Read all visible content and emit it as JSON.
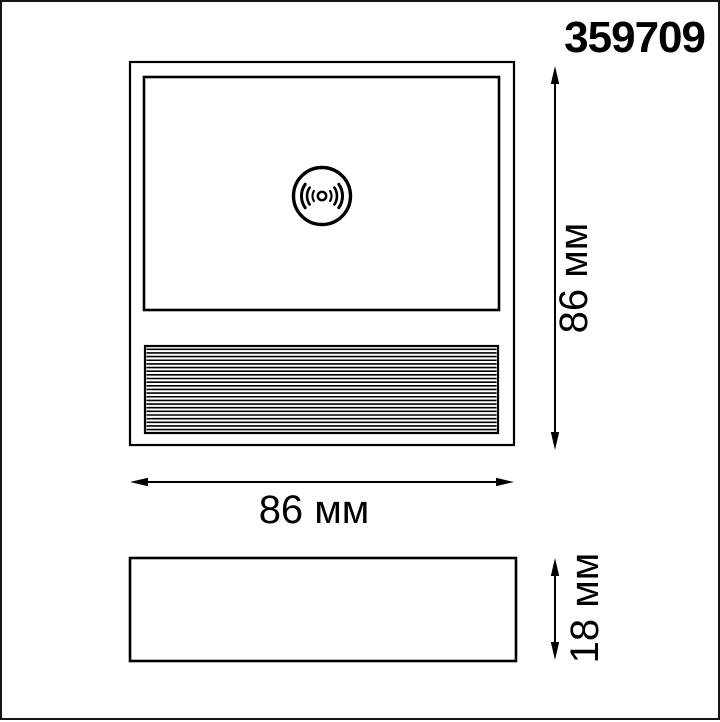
{
  "page": {
    "background_color": "#ffffff",
    "frame_border_color": "#161616",
    "line_color": "#000000"
  },
  "product": {
    "article": "359709"
  },
  "drawing": {
    "front_view": {
      "sensor_icon": "microwave-motion-sensor-icon",
      "width_dimension_label": "86 мм",
      "height_dimension_label": "86 мм"
    },
    "side_view": {
      "depth_dimension_label": "18 мм"
    }
  }
}
